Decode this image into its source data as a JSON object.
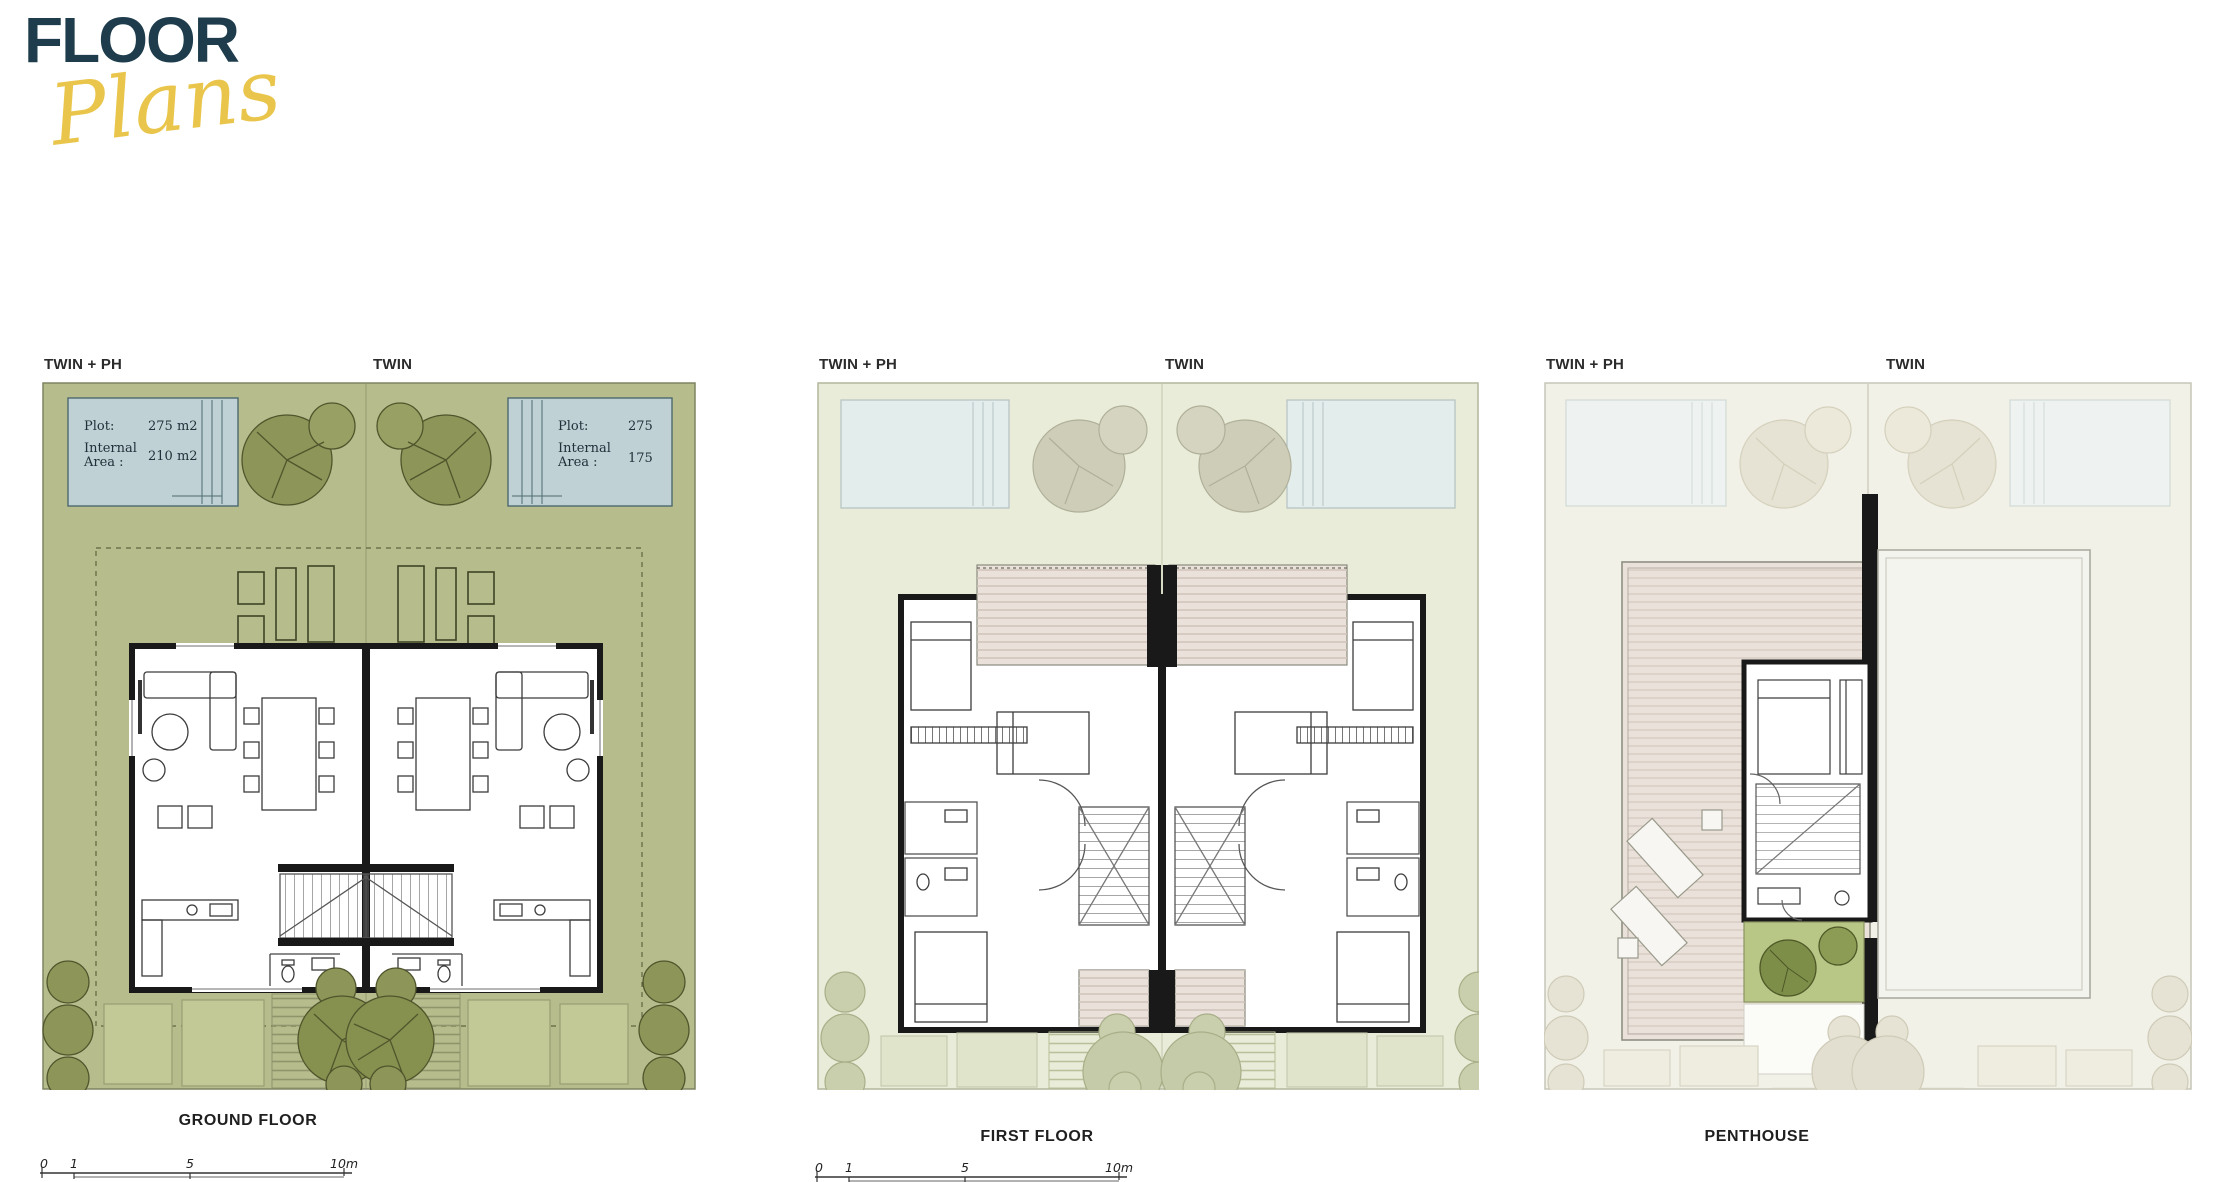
{
  "logo": {
    "title": "FLOOR",
    "subtitle": "Plans"
  },
  "colors": {
    "logo_navy": "#1e3c4b",
    "logo_gold": "#e9c64b",
    "plot_green": "#b7bc8d",
    "plot_green_light": "#e9ecd8",
    "plot_pale": "#f2f1e7",
    "pool_blue": "#bfd1d4",
    "pool_blue_faded": "#e3edec",
    "pool_blue_pale": "#eef3f1",
    "tree_olive": "#8e9559",
    "tree_faded": "#cdcdb8",
    "tree_pale": "#e6e3d4",
    "wall_black": "#191919",
    "deck_pink": "#eae2da",
    "planter_green": "#b8c686",
    "text_dark": "#1f1f1f"
  },
  "plans": {
    "ground_floor": {
      "label_left": "TWIN + PH",
      "label_right": "TWIN",
      "caption": "GROUND FLOOR",
      "pool_left_info": {
        "plot_label": "Plot:",
        "plot_value": "275 m2",
        "area_label_1": "Internal",
        "area_label_2": "Area :",
        "area_value": "210 m2"
      },
      "pool_right_info": {
        "plot_label": "Plot:",
        "plot_value": "275",
        "area_label_1": "Internal",
        "area_label_2": "Area :",
        "area_value": "175"
      },
      "scale": {
        "t0": "0",
        "t1": "1",
        "t5": "5",
        "t10": "10m"
      }
    },
    "first_floor": {
      "label_left": "TWIN + PH",
      "label_right": "TWIN",
      "caption": "FIRST FLOOR",
      "scale": {
        "t0": "0",
        "t1": "1",
        "t5": "5",
        "t10": "10m"
      }
    },
    "penthouse": {
      "label_left": "TWIN + PH",
      "label_right": "TWIN",
      "caption": "PENTHOUSE"
    }
  }
}
